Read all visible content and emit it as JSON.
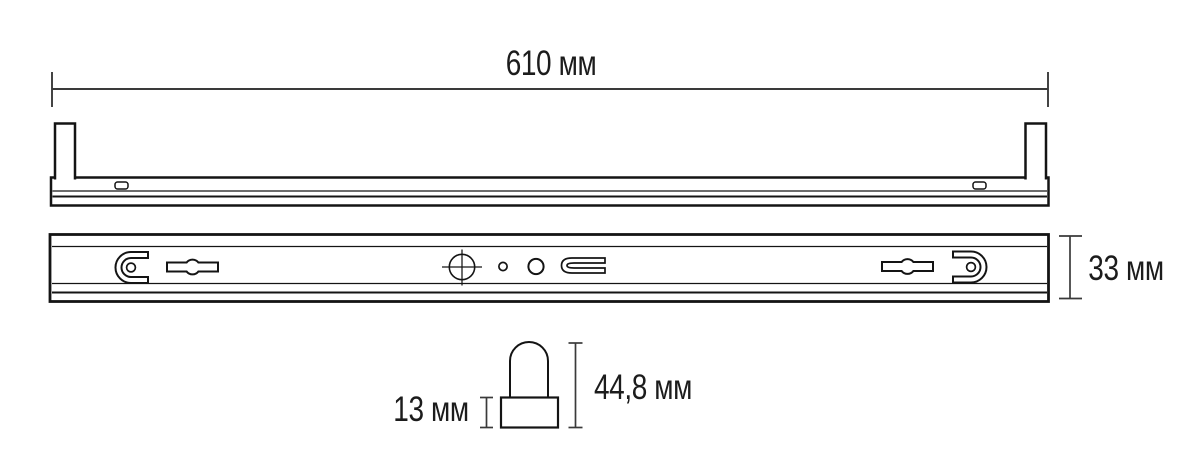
{
  "drawing": {
    "type": "technical-dimension-drawing",
    "subject": "linear lamp fixture (batten) with socket detail",
    "colors": {
      "background": "#ffffff",
      "outline": "#141414",
      "dimension_lines": "#3a3a3a",
      "text": "#1c1c1c"
    }
  },
  "dimensions": {
    "length": "610 мм",
    "height": "33 мм",
    "socket_base_height": "13 мм",
    "socket_total_height": "44,8 мм"
  }
}
